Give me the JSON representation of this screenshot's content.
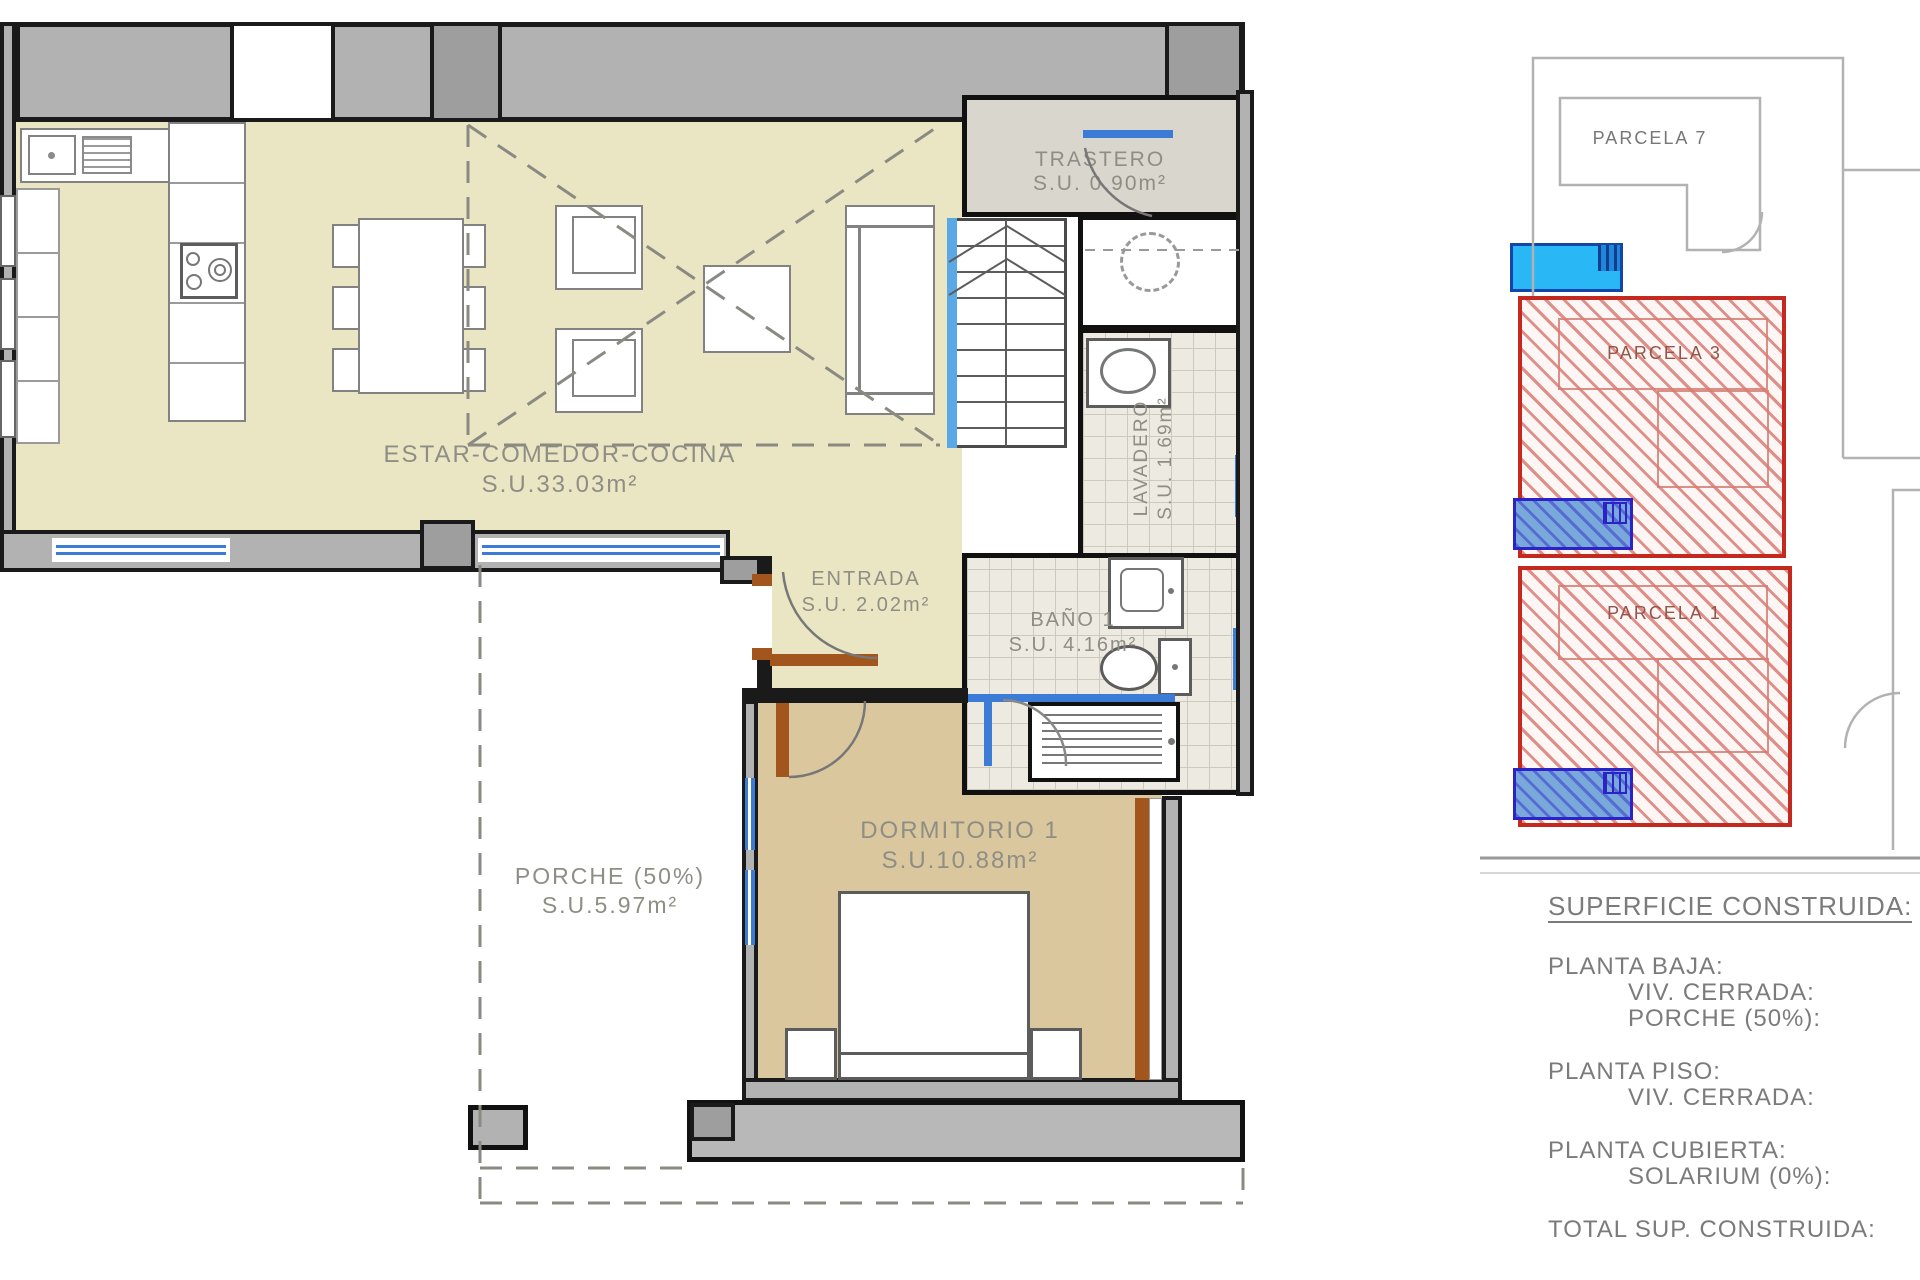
{
  "rooms": {
    "estar": {
      "name": "ESTAR-COMEDOR-COCINA",
      "area": "S.U.33.03m²"
    },
    "trastero": {
      "name": "TRASTERO",
      "area": "S.U. 0.90m²"
    },
    "lavadero": {
      "name": "LAVADERO",
      "area": "S.U. 1.69m²"
    },
    "entrada": {
      "name": "ENTRADA",
      "area": "S.U. 2.02m²"
    },
    "bano": {
      "name": "BAÑO 1",
      "area": "S.U. 4.16m²"
    },
    "dormitorio": {
      "name": "DORMITORIO 1",
      "area": "S.U.10.88m²"
    },
    "porche": {
      "name": "PORCHE (50%)",
      "area": "S.U.5.97m²"
    }
  },
  "site_plan": {
    "parcels": {
      "p7": "PARCELA 7",
      "p3": "PARCELA 3",
      "p1": "PARCELA 1"
    }
  },
  "legend": {
    "title": "SUPERFICIE CONSTRUIDA:",
    "planta_baja": "PLANTA BAJA:",
    "pb_viv": "VIV. CERRADA:",
    "pb_porche": "PORCHE (50%):",
    "planta_piso": "PLANTA PISO:",
    "pp_viv": "VIV. CERRADA:",
    "planta_cubierta": "PLANTA CUBIERTA:",
    "pc_solarium": "SOLARIUM (0%):",
    "total": "TOTAL SUP. CONSTRUIDA:"
  },
  "colors": {
    "floor_living": "#eae6c3",
    "floor_bedroom": "#dbc79e",
    "floor_trastero": "#d9d6cd",
    "wall_gray": "#b2b2b2",
    "window_blue": "#3d7cd6",
    "door_brown": "#a3551e",
    "parcel_red": "#c3291f",
    "pool_cyan": "#29b7f5",
    "pool_blue_border": "#2b22c8",
    "label_gray": "#8e8e85"
  }
}
